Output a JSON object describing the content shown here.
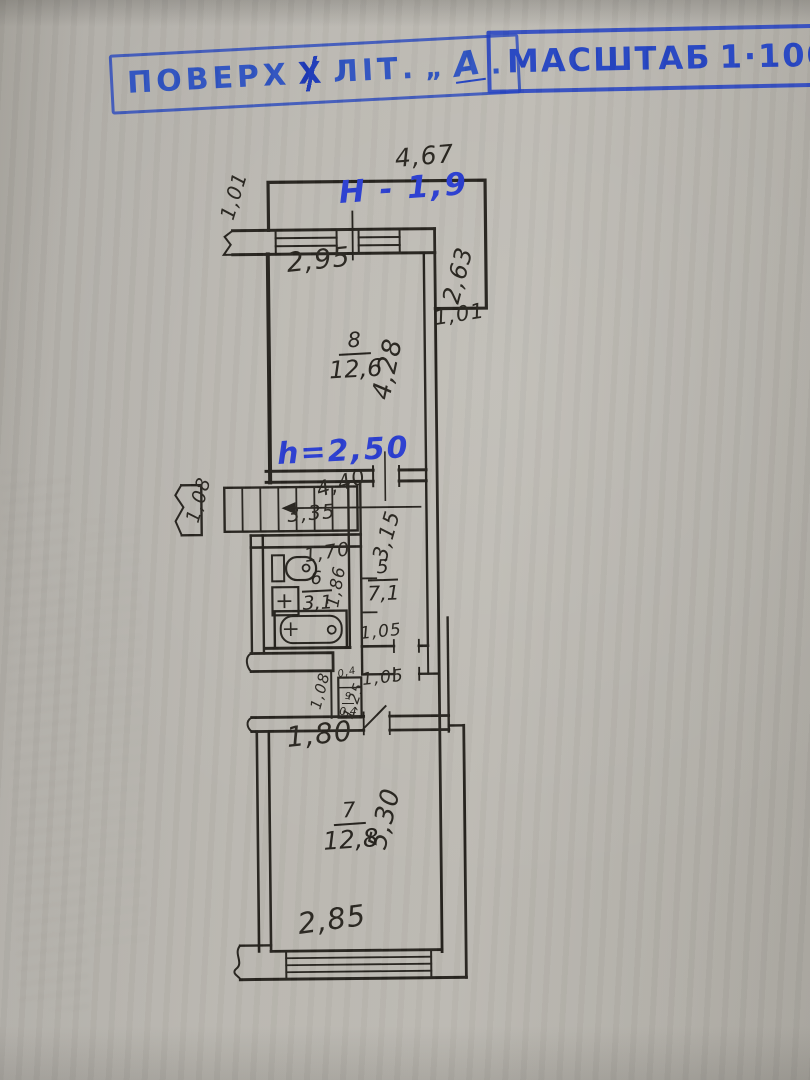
{
  "colors": {
    "paper": "#b8b5af",
    "ink": "#27241f",
    "stamp_blue": "#2f50c7",
    "pen_blue": "#2b3ed0"
  },
  "stamps": {
    "floor": {
      "prefix": "ПОВЕРХ",
      "crossed_letter": "Х",
      "suffix": "ЛІТ.",
      "open_quote": "„",
      "letter": "А",
      "end_mark": "▪"
    },
    "scale": {
      "label": "МАСШТАБ",
      "value": "1·100"
    }
  },
  "handwritten": {
    "balcony_height": "Н - 1,9",
    "ceiling_height": "h=2,50"
  },
  "rooms": [
    {
      "number": "8",
      "area": "12,6"
    },
    {
      "number": "5",
      "area": "7,1"
    },
    {
      "number": "6",
      "area": "3,1"
    },
    {
      "number": "9",
      "area": "0,4"
    },
    {
      "number": "7",
      "area": "12,8"
    }
  ],
  "dimensions": {
    "balcony_width": "4,67",
    "balcony_left": "1,01",
    "balcony_right": "2,63",
    "room8_window": "2,95",
    "room8_depth": "4,28",
    "right_offset": "1,01",
    "stairs_width": "1,08",
    "stairs_diag": "4,40",
    "stairs_run": "3,35",
    "corridor_depth": "3,15",
    "bath_width": "1,70",
    "bath_depth": "1,86",
    "door_a": "1,05",
    "door_b": "1,05",
    "entry_width": "1,08",
    "closet_top": "0,4",
    "closet_depth": "1,25",
    "hall_width": "1,80",
    "room7_depth": "5,30",
    "room7_window": "2,85"
  }
}
